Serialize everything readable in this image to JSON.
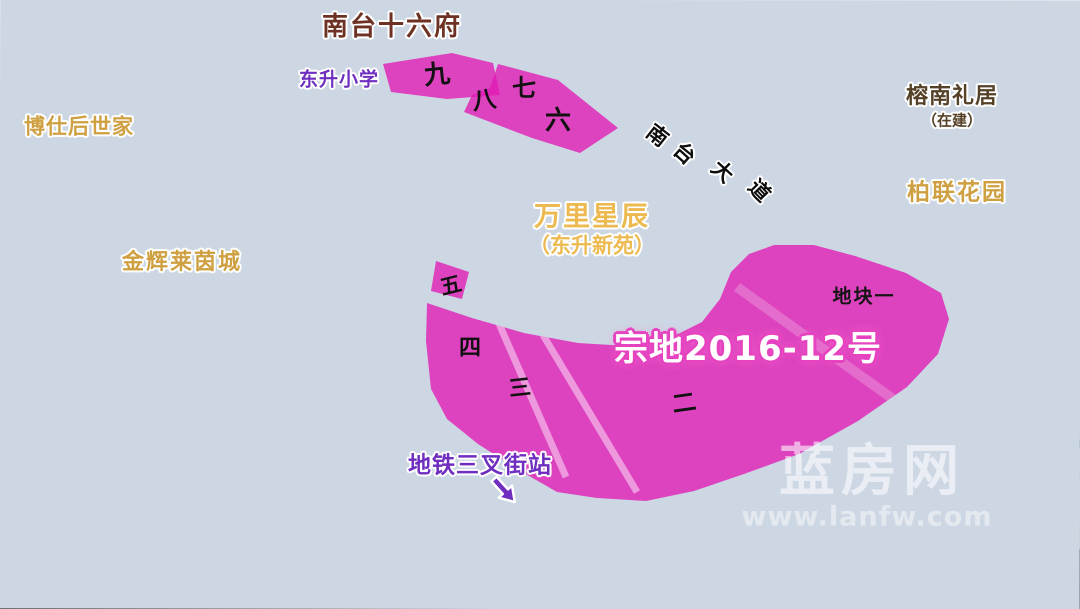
{
  "colors": {
    "parcel_overlay": "#e119b4",
    "gold_label": "#cfa041",
    "gold_bright": "#ecba50",
    "purple_label": "#6f2ec0",
    "maroon_label": "#6e3224",
    "olive_label": "#554128",
    "zone_title_fill": "#ffffff",
    "zone_title_outline": "#e643c0"
  },
  "labels": {
    "nantai_shiliufu": "南台十六府",
    "dongsheng_school": "东升小学",
    "boshihou": "博仕后世家",
    "jinhui": "金辉莱茵城",
    "rongnan": "榕南礼居",
    "rongnan_status": "（在建）",
    "bolian": "柏联花园",
    "wanli": "万里星辰",
    "wanli_sub": "（东升新苑）",
    "metro": "地铁三叉街站"
  },
  "road": {
    "name": "南台大道",
    "chars": [
      "南",
      "台",
      "大",
      "道"
    ]
  },
  "parcels": {
    "zone_title": "宗地2016-12号",
    "block_one": "地块一",
    "numbers": [
      "九",
      "八",
      "七",
      "六",
      "五",
      "四",
      "三",
      "二"
    ]
  },
  "icons": {
    "metro_arrow": "arrow-down-right"
  },
  "watermark": {
    "site": "蓝房网",
    "url": "www.lanfw.com"
  }
}
